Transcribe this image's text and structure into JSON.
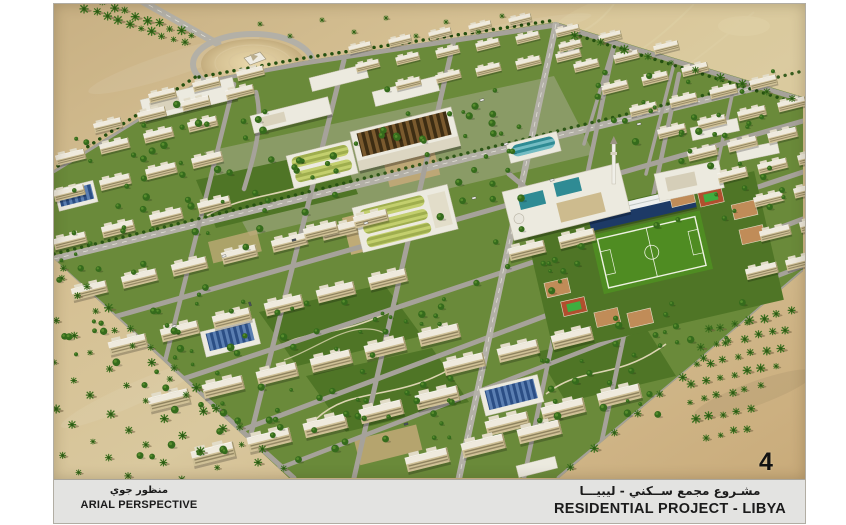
{
  "sheet": {
    "page_number": "4",
    "footer": {
      "left": {
        "arabic": "منظور جوي",
        "english": "ARIAL PERSPECTIVE"
      },
      "right": {
        "arabic": "مشـروع مجمع ســكني - ليبيـــا",
        "english": "RESIDENTIAL PROJECT - LIBYA"
      }
    }
  },
  "palette": {
    "frame": "#b1ada3",
    "footerBg": "#e3e3e1",
    "ink": "#1b1b1b",
    "sand1": "#c8b083",
    "sand2": "#d9c89e",
    "sand3": "#c9ab7a",
    "grass": "#6a8a3a",
    "grassDark": "#4f7526",
    "tree": "#356b1c",
    "treeDark": "#24500f",
    "palm": "#3c701f",
    "road": "#a6a29a",
    "roadMain": "#b3b0a7",
    "paving": "#b7b2a5",
    "wall": "#cfc096",
    "wallShade": "#a5986f",
    "roof": "#efeadd",
    "roofStep": "#e2dcc8",
    "white": "#eceadf",
    "whiteStroke": "#c8c3b2",
    "saw1": "#7a5a2e",
    "saw2": "#3d2d13",
    "grn1": "#9fae4e",
    "grn2": "#c3cf6d",
    "teal1": "#2f8b94",
    "teal2": "#74bcc3",
    "blu1": "#2b4e85",
    "blu2": "#5b7fb2",
    "navy": "#1d3a66",
    "field1": "#6ab833",
    "field2": "#58a528",
    "fieldEdge": "#4f8c22",
    "courtTan": "#c08c58",
    "courtRed": "#b14f2e",
    "courtGrn": "#3fae3f",
    "path": "#dcd4b2",
    "mound1": "#ead9ac",
    "mound2": "#c4ad7e"
  }
}
